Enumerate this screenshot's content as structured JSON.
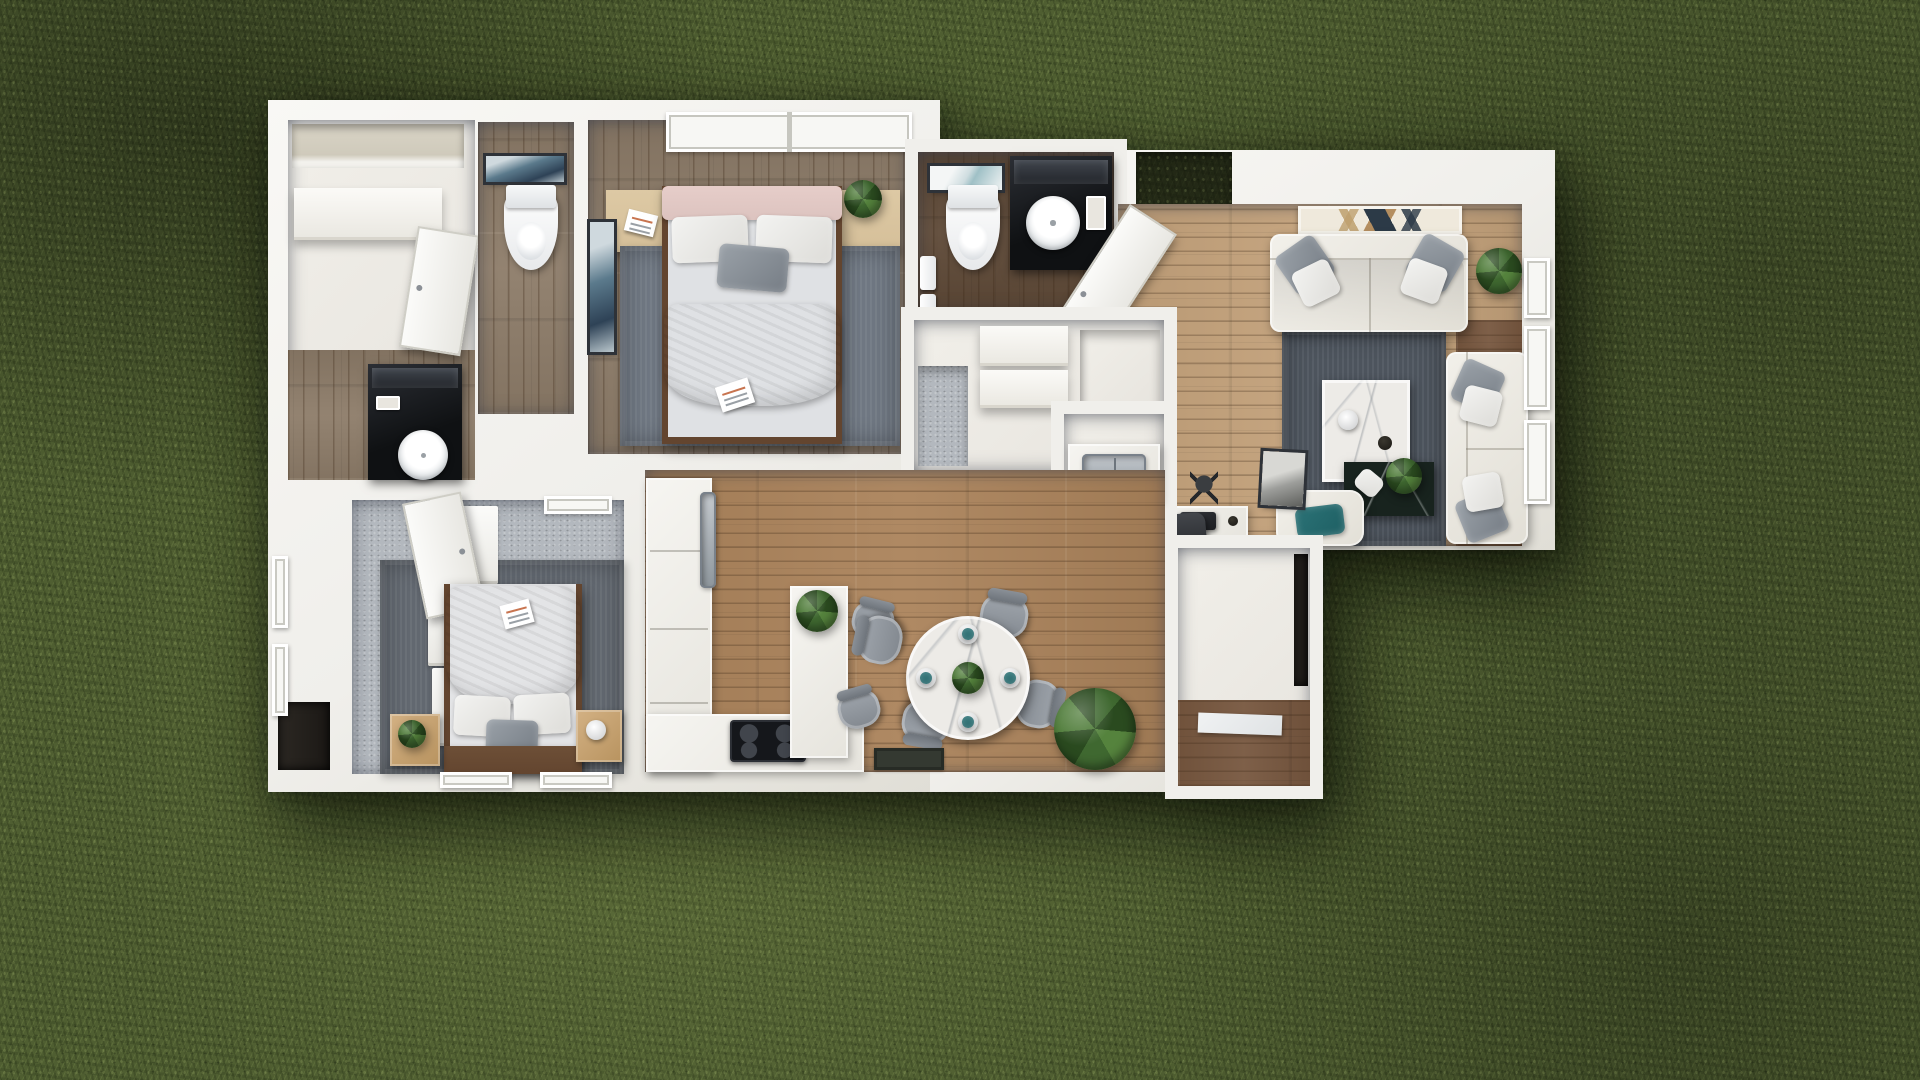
{
  "scene": {
    "title": "Top-down 3D rendered floor plan of a two-bedroom home on a grass lawn",
    "view": "top-down architectural render",
    "canvas": {
      "width": 1920,
      "height": 1080
    }
  },
  "colors": {
    "grass_base": "#4f5e31",
    "grass_dark": "#33401e",
    "grass_light": "#7c8f4c",
    "wall": "#f0efeb",
    "wall_hi": "#f9f8f5",
    "wall_lo": "#e0ded6",
    "floor_white": "#e7e4de",
    "wood_gray": "#8d7c69",
    "wood_dark": "#5e4937",
    "wood_oak": "#c4a27b",
    "wood_kitchen": "#ab835b",
    "wood_entry": "#77573f",
    "carpet": "#b3b8be",
    "rug_slate": "#7c8591",
    "rug_bd2": "#6d747d",
    "rug_living": "#565e68",
    "black": "#141619",
    "marble": "#edebe7",
    "marble_dark": "#18231e",
    "steel": "#aab2b8",
    "teal": "#1e5f63",
    "pink": "#dcc3bf",
    "plant": "#3f6830",
    "plant_dark": "#2a4a1f",
    "wood_frame": "#63452f",
    "wood_shelf": "#d5bf99",
    "gray_chair": "#8e949b"
  },
  "rooms": {
    "closet_suite": {
      "name": "Walk-in closet + ensuite",
      "floor": "white / gray wood",
      "furniture": [
        "shelf niche",
        "closet shelf",
        "wardrobe door ajar",
        "black vanity with round vessel sink",
        "amenity tray"
      ]
    },
    "wc": {
      "name": "Water closet",
      "floor": "gray wood planks",
      "furniture": [
        "toilet",
        "framed wall art"
      ]
    },
    "bedroom_1": {
      "name": "Bedroom 1",
      "floor": "gray wood + slate rug",
      "furniture": [
        "double bed with pink bolster",
        "wood headboard shelf",
        "book",
        "potted plant",
        "blue wall art",
        "window pair"
      ]
    },
    "bathroom_2": {
      "name": "Bathroom",
      "floor": "dark wood planks",
      "furniture": [
        "toilet",
        "botanical wall art",
        "black vanity with round vessel sink",
        "mirror",
        "hanging towels"
      ]
    },
    "closets": {
      "name": "Hall closets",
      "floor": "white + carpet",
      "furniture": [
        "carpeted closet",
        "linen shelves",
        "pantry cell"
      ]
    },
    "laundry": {
      "name": "Laundry / utility",
      "floor": "white",
      "furniture": [
        "counter",
        "double stainless sink",
        "lower cabinet"
      ]
    },
    "entry": {
      "name": "Entry",
      "furniture": [
        "open front door",
        "porch recess with grass"
      ]
    },
    "living_room": {
      "name": "Living room",
      "floor": "light oak + dark oak border",
      "furniture": [
        "geometric media console",
        "three-seat sofa",
        "two-seat sofa",
        "armchair with teal pillow",
        "dark area rug",
        "white marble coffee table",
        "black marble side table with plant",
        "corner plant",
        "floor lamp",
        "desk with laptop and chair",
        "leaning art frame",
        "three windows"
      ]
    },
    "kitchen": {
      "name": "Kitchen",
      "floor": "oak planks",
      "furniture": [
        "L-shaped counter",
        "stainless fridge front",
        "black cooktop",
        "island with plant",
        "two bar stools"
      ]
    },
    "dining": {
      "name": "Dining area",
      "floor": "oak planks",
      "furniture": [
        "round marble table",
        "four gray chairs",
        "place settings",
        "centerpiece plant",
        "large floor plant",
        "dark doormat"
      ]
    },
    "entry_hall": {
      "name": "Rear entry hall",
      "floor": "white + dark wood",
      "furniture": [
        "white runner mat",
        "dark recess"
      ]
    },
    "bedroom_2": {
      "name": "Bedroom 2",
      "floor": "light carpet + slate rug",
      "furniture": [
        "double bed with wood headboard",
        "stepped white wardrobe",
        "door ajar",
        "two nightstands",
        "plant",
        "lamp",
        "magazine",
        "left wall windows"
      ]
    }
  }
}
